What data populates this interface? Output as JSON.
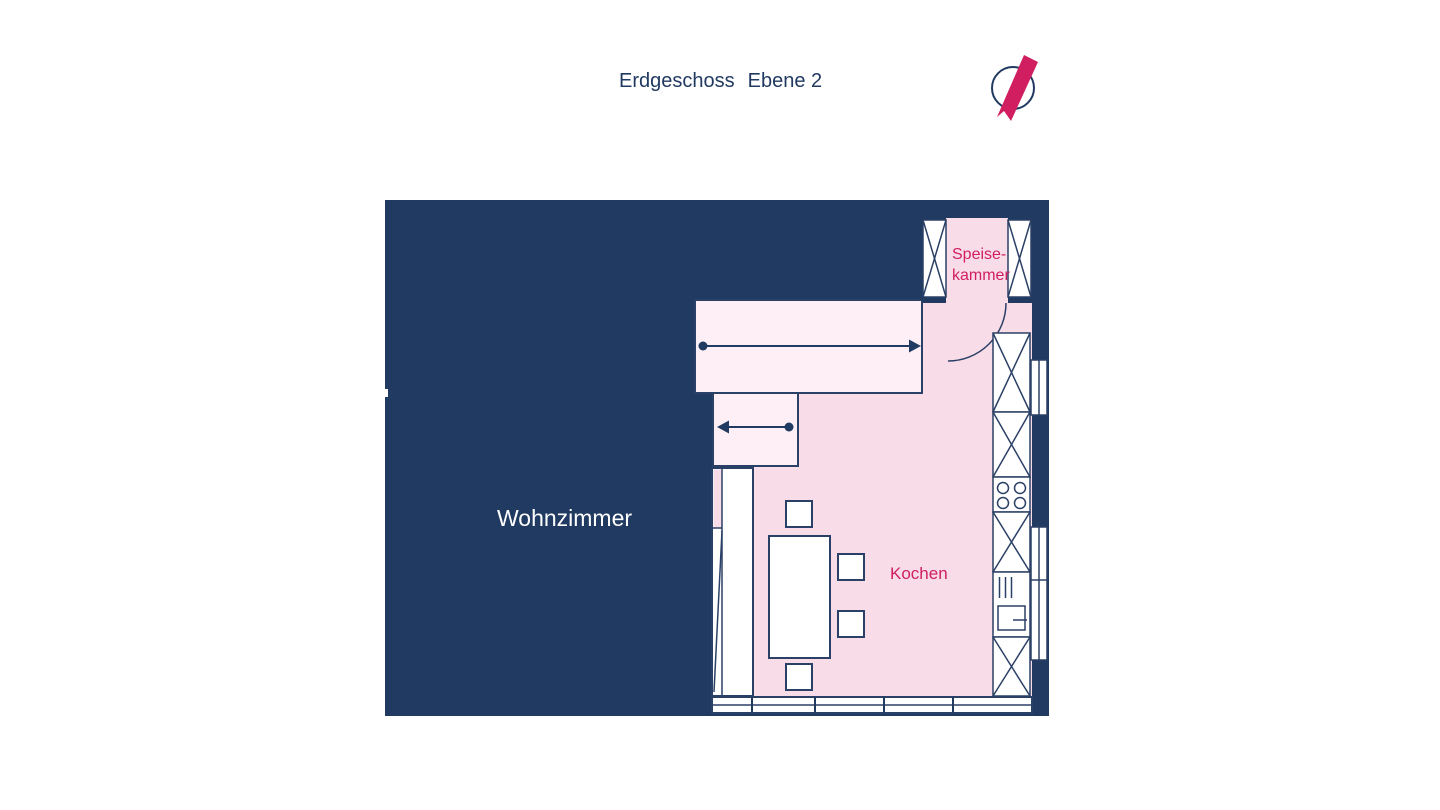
{
  "title": {
    "floor": "Erdgeschoss",
    "level": "Ebene 2"
  },
  "rooms": {
    "living": "Wohnzimmer",
    "kitchen": "Kochen",
    "pantry_line1": "Speise-",
    "pantry_line2": "kammer"
  },
  "icons": {
    "compass": "north-arrow"
  },
  "colors": {
    "navy": "#213a61",
    "kitchen_pink": "#f8dde9",
    "door_zone_pink": "#fdeff5",
    "accent_pink": "#d01e60",
    "background": "#ffffff"
  }
}
